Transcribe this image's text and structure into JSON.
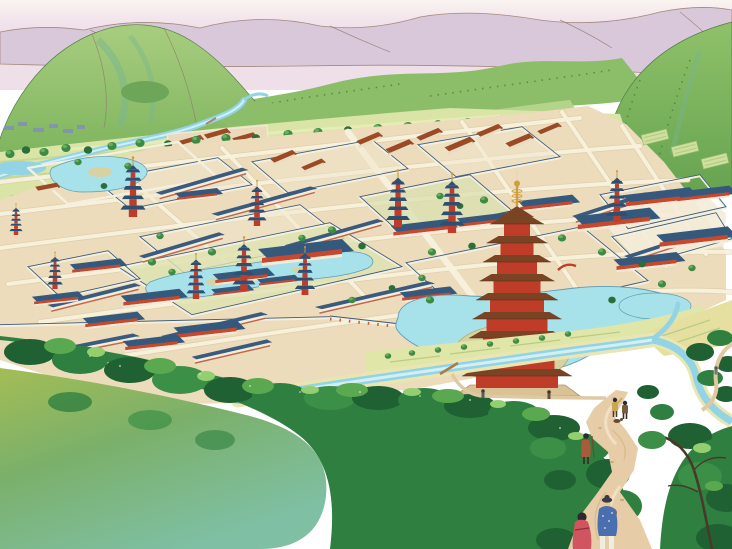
{
  "scene": {
    "type": "watercolor aerial illustration",
    "subject": "ancient-capital-city-with-temple-compounds",
    "landmarks": [
      "distant-purple-mountain-range",
      "green-hills",
      "farm-plain-with-winding-river",
      "walled-city-grid-of-temple-compounds",
      "nine-story-great-pagoda-on-pond-island",
      "five-story-pagodas",
      "garden-ponds",
      "south-city-wall-with-gate",
      "riverside-fields",
      "foreground-forest",
      "winding-footpath-with-travelers"
    ],
    "counts": {
      "great_pagoda_stories": 9,
      "small_pagodas": 9,
      "foreground_travelers": 2,
      "distant_travelers": 5
    },
    "figures": [
      {
        "id": "woman-in-red-kimono",
        "colors": [
          "#d15560",
          "#2c2a30"
        ]
      },
      {
        "id": "man-in-blue-jacket",
        "colors": [
          "#4b6fae",
          "#efece0",
          "#3a3a42"
        ]
      },
      {
        "id": "traveler-brown",
        "colors": [
          "#a85c3c"
        ]
      },
      {
        "id": "traveler-yellow",
        "colors": [
          "#c8a84c"
        ]
      },
      {
        "id": "traveler-dark",
        "colors": [
          "#7a5a3c"
        ]
      }
    ]
  },
  "palette": {
    "sky_top": "#faf4f0",
    "sky_pink": "#eedfe9",
    "mountain_far": "#d9c8da",
    "hill_light": "#b5d48b",
    "hill_mid": "#8cbd68",
    "hill_dark": "#6da659",
    "hill_teal": "#79b592",
    "plain": "#d9e4a6",
    "water": "#92d4e6",
    "water_light": "#d2eff5",
    "ground": "#ecdcbb",
    "road": "#f8f1dd",
    "wall_white": "#f4efdf",
    "roof_blue": "#35597c",
    "red_building": "#c7482c",
    "rust_roof": "#9c4a26",
    "pagoda_roof": "#7a4323",
    "pagoda_body": "#bf3d28",
    "gold": "#cf9e3e",
    "pond": "#a7e2ea",
    "island": "#d8d2a0",
    "field": "#dfe6a8",
    "forest_dark": "#1f6132",
    "forest_mid": "#2f8040",
    "forest_light": "#5aa84f",
    "forest_highlight": "#93cf70",
    "wash_olive": "#a3bd55",
    "wash_teal": "#7fc0a5",
    "path": "#e7cda7",
    "figure_red": "#d15560",
    "figure_blue": "#4b6fae",
    "bridge_red": "#c23a28"
  }
}
